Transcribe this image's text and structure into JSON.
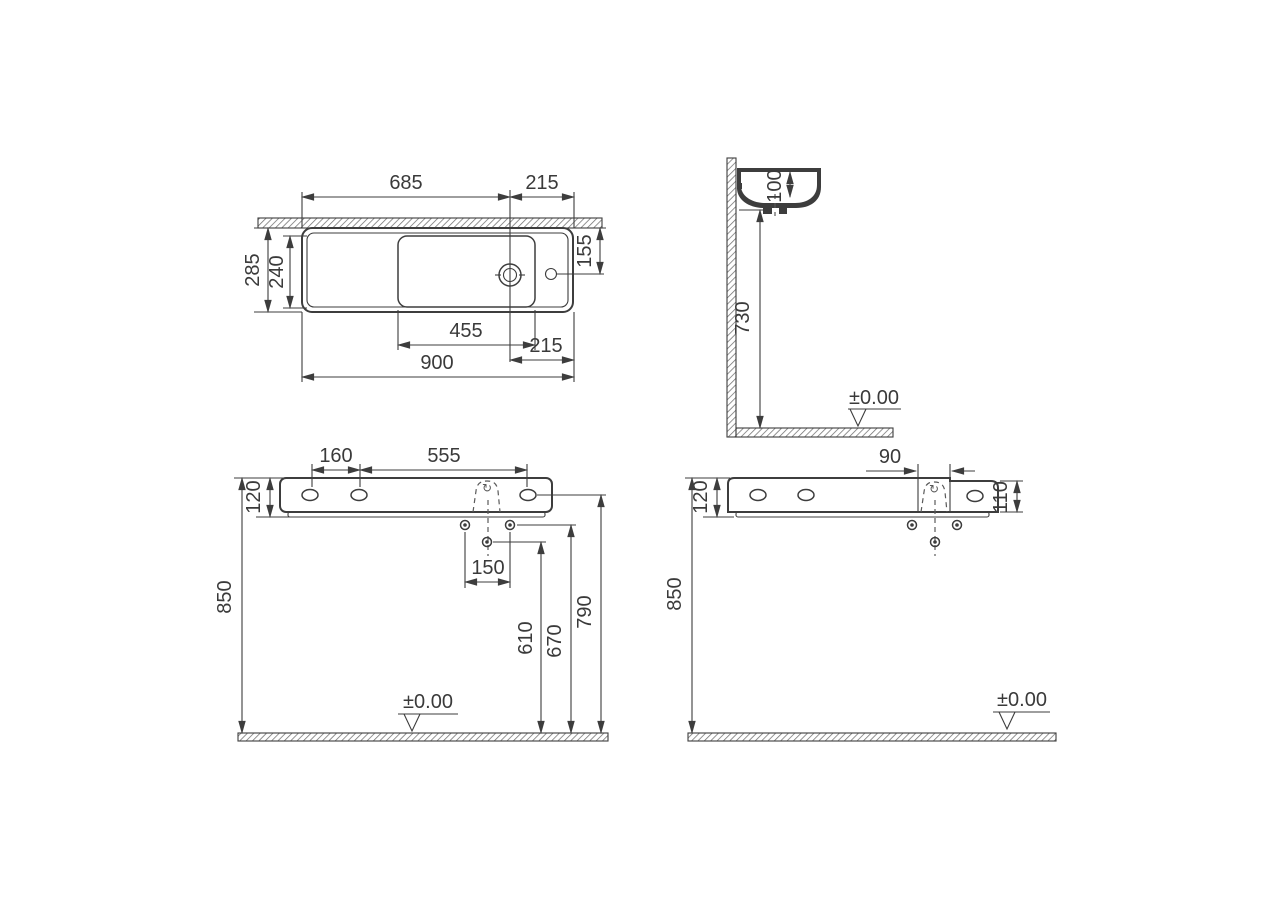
{
  "drawing": {
    "background": "#ffffff",
    "line_color": "#3d3d3d",
    "siphon_symbol": "↻",
    "plan": {
      "width_left": "685",
      "width_right": "215",
      "depth_outer": "285",
      "depth_inner": "240",
      "tap_offset": "155",
      "bowl_width": "455",
      "drain_to_edge": "215",
      "overall_width": "900"
    },
    "side": {
      "bowl_depth": "100",
      "underside_height": "730",
      "datum": "±0.00"
    },
    "front": {
      "hole_pitch": "160",
      "hole_span": "555",
      "rim_height": "120",
      "mount_height": "850",
      "fixing_pitch": "150",
      "drain_height": "610",
      "fixing_height": "670",
      "tap_height": "790",
      "datum": "±0.00"
    },
    "rear": {
      "rim_height": "120",
      "trap_width": "90",
      "right_height": "110",
      "mount_height": "850",
      "datum": "±0.00"
    }
  }
}
